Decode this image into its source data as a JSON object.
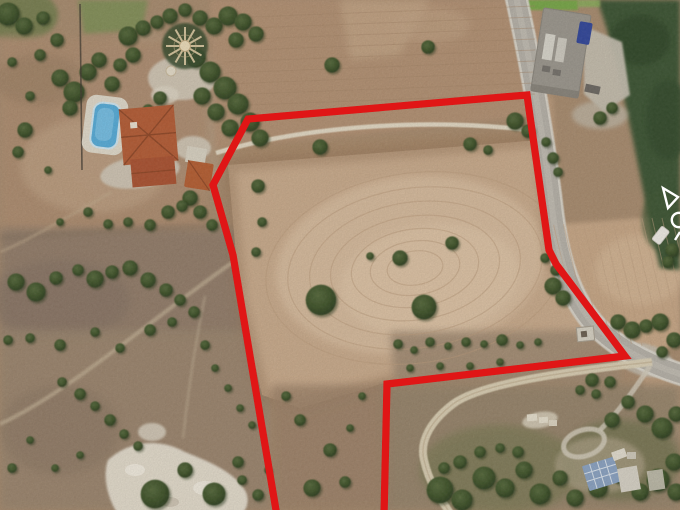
{
  "canvas": {
    "width": 680,
    "height": 510
  },
  "scene_name": "aerial-land-parcel-photo",
  "boundary": {
    "color": "#e01212",
    "stroke_width": 7.2,
    "points": "277,516 233,255 213,185 248,119 527,95 549,250 556,264 625,356 387,384 384,516"
  },
  "watermark": {
    "color": "#ffffff",
    "glyphs": [
      "triangle-outline",
      "ring-outline",
      "tick"
    ]
  },
  "palette": {
    "base_earth": "#a88b6e",
    "field_tan": "#c9aa8b",
    "field_light": "#dabfa1",
    "scrub_gray": "#8f7a69",
    "forest_green": "#3b5230",
    "road_gray": "#b6b1a8",
    "road_casing": "#dbd7cd",
    "dirt_track": "#e9e1cd",
    "dirt_road": "#ddd1b6",
    "pool_blue": "#56acd9",
    "pool_deck": "#e3ddcf",
    "roof_terracotta": "#b45b34",
    "roof_terracotta_dark": "#aa5130",
    "farm_roof_gray": "#9b968d",
    "farm_apron": "#c6bfb0",
    "truck_blue": "#30459a",
    "solar_roof_blue": "#8aa2c2",
    "green_strip": "#74a844",
    "rock_white": "#e7e0d1"
  },
  "furrows": {
    "cx": 415,
    "cy": 268,
    "rot": -8,
    "color": "#bb9b7c",
    "rings": [
      [
        150,
        95
      ],
      [
        128,
        80
      ],
      [
        106,
        66
      ],
      [
        85,
        52
      ],
      [
        64,
        39
      ],
      [
        45,
        27
      ],
      [
        28,
        17
      ]
    ]
  },
  "furrows_right": {
    "x": 552,
    "y": 218,
    "dx": 10,
    "len_x": 30,
    "len_y": 128,
    "count": 13,
    "color": "#c0a081"
  },
  "furrows_top": {
    "x": 225,
    "y": 18,
    "dy": 11,
    "count": 9,
    "x2": 535,
    "y2": 6,
    "color": "#a58466"
  },
  "trees": [
    [
      8,
      14,
      12
    ],
    [
      24,
      26,
      9
    ],
    [
      43,
      18,
      7
    ],
    [
      57,
      40,
      7
    ],
    [
      40,
      55,
      6
    ],
    [
      60,
      78,
      9
    ],
    [
      74,
      92,
      11
    ],
    [
      88,
      72,
      9
    ],
    [
      99,
      60,
      8
    ],
    [
      112,
      84,
      8
    ],
    [
      70,
      108,
      8
    ],
    [
      128,
      36,
      10
    ],
    [
      143,
      28,
      8
    ],
    [
      157,
      22,
      7
    ],
    [
      133,
      55,
      8
    ],
    [
      120,
      65,
      7
    ],
    [
      170,
      16,
      8
    ],
    [
      185,
      10,
      7
    ],
    [
      200,
      18,
      8
    ],
    [
      214,
      26,
      9
    ],
    [
      228,
      16,
      10
    ],
    [
      243,
      22,
      9
    ],
    [
      256,
      34,
      8
    ],
    [
      236,
      40,
      8
    ],
    [
      196,
      58,
      10
    ],
    [
      210,
      72,
      11
    ],
    [
      225,
      88,
      12
    ],
    [
      238,
      104,
      11
    ],
    [
      250,
      122,
      10
    ],
    [
      260,
      138,
      9
    ],
    [
      230,
      128,
      9
    ],
    [
      216,
      112,
      9
    ],
    [
      202,
      96,
      9
    ],
    [
      160,
      98,
      7
    ],
    [
      148,
      110,
      6
    ],
    [
      190,
      198,
      8
    ],
    [
      200,
      212,
      7
    ],
    [
      212,
      225,
      6
    ],
    [
      332,
      65,
      8
    ],
    [
      428,
      47,
      7
    ],
    [
      515,
      121,
      9
    ],
    [
      528,
      131,
      7
    ],
    [
      320,
      147,
      8
    ],
    [
      470,
      144,
      7
    ],
    [
      488,
      150,
      5
    ],
    [
      258,
      186,
      7
    ],
    [
      262,
      222,
      5
    ],
    [
      256,
      252,
      5
    ],
    [
      321,
      300,
      16
    ],
    [
      424,
      307,
      13
    ],
    [
      400,
      258,
      8
    ],
    [
      452,
      243,
      7
    ],
    [
      370,
      256,
      4
    ],
    [
      12,
      62,
      5
    ],
    [
      30,
      96,
      5
    ],
    [
      25,
      130,
      8
    ],
    [
      18,
      152,
      6
    ],
    [
      48,
      170,
      4
    ],
    [
      88,
      212,
      5
    ],
    [
      108,
      224,
      5
    ],
    [
      128,
      222,
      5
    ],
    [
      150,
      225,
      6
    ],
    [
      168,
      212,
      7
    ],
    [
      182,
      206,
      6
    ],
    [
      60,
      222,
      4
    ],
    [
      16,
      282,
      9
    ],
    [
      36,
      292,
      10
    ],
    [
      56,
      278,
      7
    ],
    [
      78,
      270,
      6
    ],
    [
      95,
      279,
      9
    ],
    [
      112,
      272,
      7
    ],
    [
      130,
      268,
      8
    ],
    [
      148,
      280,
      8
    ],
    [
      166,
      290,
      7
    ],
    [
      180,
      300,
      6
    ],
    [
      150,
      330,
      6
    ],
    [
      172,
      322,
      5
    ],
    [
      194,
      312,
      6
    ],
    [
      120,
      348,
      5
    ],
    [
      95,
      332,
      5
    ],
    [
      60,
      345,
      6
    ],
    [
      30,
      338,
      5
    ],
    [
      8,
      340,
      5
    ],
    [
      205,
      345,
      5
    ],
    [
      215,
      368,
      4
    ],
    [
      228,
      388,
      4
    ],
    [
      240,
      408,
      4
    ],
    [
      252,
      425,
      4
    ],
    [
      62,
      382,
      5
    ],
    [
      80,
      394,
      6
    ],
    [
      95,
      406,
      5
    ],
    [
      110,
      420,
      6
    ],
    [
      124,
      434,
      5
    ],
    [
      138,
      446,
      5
    ],
    [
      30,
      440,
      4
    ],
    [
      12,
      468,
      5
    ],
    [
      55,
      468,
      4
    ],
    [
      80,
      455,
      4
    ],
    [
      155,
      494,
      15
    ],
    [
      185,
      470,
      8
    ],
    [
      214,
      494,
      12
    ],
    [
      238,
      462,
      6
    ],
    [
      242,
      480,
      5
    ],
    [
      258,
      495,
      6
    ],
    [
      268,
      470,
      4
    ],
    [
      300,
      420,
      6
    ],
    [
      286,
      396,
      5
    ],
    [
      330,
      450,
      7
    ],
    [
      312,
      488,
      9
    ],
    [
      345,
      482,
      6
    ],
    [
      362,
      396,
      4
    ],
    [
      350,
      428,
      4
    ],
    [
      398,
      344,
      5
    ],
    [
      414,
      350,
      4
    ],
    [
      430,
      342,
      5
    ],
    [
      448,
      346,
      4
    ],
    [
      466,
      342,
      5
    ],
    [
      484,
      344,
      4
    ],
    [
      502,
      340,
      6
    ],
    [
      520,
      345,
      4
    ],
    [
      538,
      342,
      4
    ],
    [
      410,
      368,
      4
    ],
    [
      440,
      366,
      4
    ],
    [
      470,
      366,
      4
    ],
    [
      500,
      362,
      4
    ],
    [
      546,
      142,
      5
    ],
    [
      553,
      158,
      6
    ],
    [
      558,
      172,
      5
    ],
    [
      553,
      286,
      9
    ],
    [
      563,
      298,
      8
    ],
    [
      556,
      270,
      6
    ],
    [
      545,
      258,
      5
    ],
    [
      618,
      322,
      8
    ],
    [
      632,
      330,
      9
    ],
    [
      646,
      326,
      7
    ],
    [
      660,
      322,
      9
    ],
    [
      674,
      340,
      8
    ],
    [
      662,
      352,
      6
    ],
    [
      672,
      250,
      7
    ],
    [
      668,
      262,
      6
    ],
    [
      600,
      118,
      7
    ],
    [
      612,
      108,
      6
    ],
    [
      592,
      380,
      7
    ],
    [
      610,
      382,
      6
    ],
    [
      596,
      394,
      5
    ],
    [
      580,
      390,
      5
    ],
    [
      612,
      420,
      8
    ],
    [
      628,
      402,
      7
    ],
    [
      645,
      414,
      9
    ],
    [
      662,
      428,
      11
    ],
    [
      676,
      414,
      8
    ],
    [
      440,
      490,
      14
    ],
    [
      462,
      500,
      11
    ],
    [
      484,
      478,
      12
    ],
    [
      505,
      488,
      10
    ],
    [
      524,
      470,
      9
    ],
    [
      540,
      494,
      11
    ],
    [
      560,
      478,
      8
    ],
    [
      575,
      498,
      9
    ],
    [
      598,
      488,
      10
    ],
    [
      620,
      476,
      8
    ],
    [
      640,
      492,
      9
    ],
    [
      658,
      480,
      12
    ],
    [
      674,
      462,
      9
    ],
    [
      676,
      492,
      9
    ],
    [
      518,
      452,
      6
    ],
    [
      500,
      448,
      5
    ],
    [
      480,
      452,
      6
    ],
    [
      460,
      462,
      7
    ],
    [
      444,
      468,
      6
    ]
  ]
}
